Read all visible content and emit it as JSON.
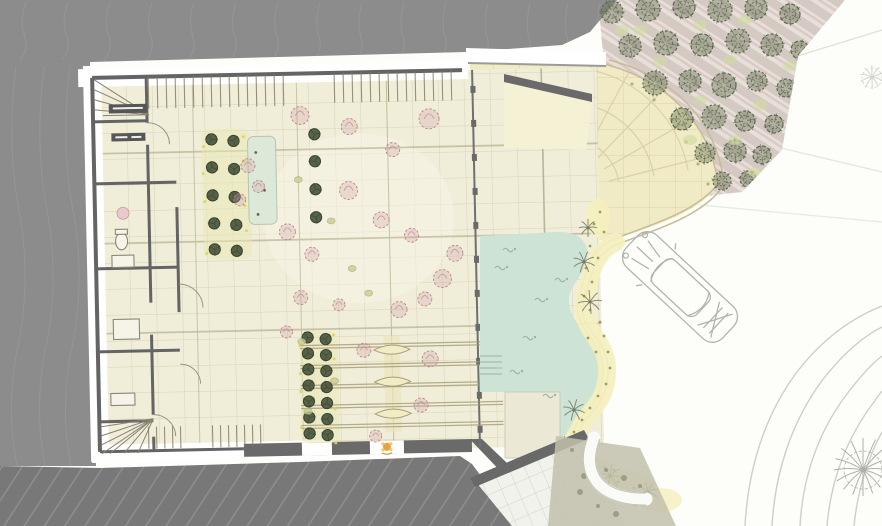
{
  "meta": {
    "drawing_type": "architectural-first-floor-site-plan",
    "canvas": {
      "width": 882,
      "height": 526
    },
    "visible_text": "none"
  },
  "palette": {
    "white": "#fdfdfa",
    "bg_gray": "#8c8c8c",
    "contour": "#9d9d9d",
    "hatch_base": "#787878",
    "hatch_line": "#8d8d8d",
    "wall": "#646464",
    "wall_dark": "#565656",
    "band": "#ffffff",
    "floor": "#f0edd9",
    "floor_grid": "#c1b897",
    "olive_line": "#a49a74",
    "plaza": "#f0ebc5",
    "plaza_line": "#d6cc9f",
    "tan_edge": "#c8bb95",
    "pool": "#cde3d5",
    "pool_line": "#9ab3a8",
    "deck": "#ece8d6",
    "tree_green": "#5c6850",
    "tree_fill": "#687554",
    "ground_tuft": "#cfdc9f",
    "stripe_a": "#d5c9c3",
    "stripe_b": "#e7e0d9",
    "stripe_pink": "#dcc9c7",
    "veg_yellow": "#f5efbe",
    "veg_dot": "#8f9148",
    "palm": "#737a66",
    "plant_dark": "#45523a",
    "plant_dot": "#dcd35a",
    "pink": "#bb8790",
    "pink_fill": "#cd96a0",
    "water_feature": "#dde9d8",
    "road_line": "#cfcfc8",
    "car_stroke": "#b4b4ae",
    "pave": "#f2f2ed",
    "pave_line": "#d3d3cb",
    "sketch_gray": "#a3a39c",
    "flower_orange": "#e8a23c"
  },
  "site": {
    "trees": [
      [
        612,
        12,
        11
      ],
      [
        648,
        9,
        12
      ],
      [
        684,
        7,
        11
      ],
      [
        720,
        10,
        12
      ],
      [
        756,
        8,
        11
      ],
      [
        790,
        14,
        10
      ],
      [
        630,
        46,
        11
      ],
      [
        666,
        43,
        12
      ],
      [
        702,
        45,
        11
      ],
      [
        738,
        41,
        12
      ],
      [
        772,
        45,
        11
      ],
      [
        800,
        50,
        9
      ],
      [
        655,
        83,
        12
      ],
      [
        690,
        81,
        11
      ],
      [
        724,
        85,
        12
      ],
      [
        757,
        81,
        10
      ],
      [
        786,
        88,
        9
      ],
      [
        682,
        119,
        11
      ],
      [
        714,
        117,
        12
      ],
      [
        745,
        121,
        10
      ],
      [
        774,
        124,
        9
      ],
      [
        705,
        153,
        10
      ],
      [
        735,
        151,
        11
      ],
      [
        762,
        155,
        9
      ],
      [
        722,
        181,
        9
      ],
      [
        748,
        179,
        8
      ]
    ],
    "tree_tufts": [
      [
        622,
        30
      ],
      [
        700,
        25
      ],
      [
        745,
        20
      ],
      [
        660,
        62
      ],
      [
        730,
        60
      ],
      [
        790,
        66
      ],
      [
        700,
        100
      ],
      [
        760,
        105
      ],
      [
        735,
        140
      ],
      [
        690,
        140
      ],
      [
        755,
        172
      ],
      [
        640,
        30
      ]
    ],
    "palms": [
      [
        588,
        228,
        9
      ],
      [
        584,
        262,
        11
      ],
      [
        590,
        302,
        12
      ],
      [
        574,
        410,
        11
      ],
      [
        566,
        446,
        10
      ],
      [
        610,
        476,
        12
      ],
      [
        648,
        492,
        10
      ]
    ],
    "veg_dots": [
      [
        600,
        212
      ],
      [
        594,
        224
      ],
      [
        604,
        232
      ],
      [
        590,
        246
      ],
      [
        598,
        258
      ],
      [
        586,
        268
      ],
      [
        592,
        282
      ],
      [
        584,
        296
      ],
      [
        590,
        310
      ],
      [
        600,
        322
      ],
      [
        604,
        336
      ],
      [
        608,
        352
      ],
      [
        610,
        368
      ],
      [
        606,
        384
      ],
      [
        598,
        396
      ],
      [
        590,
        408
      ],
      [
        582,
        420
      ],
      [
        574,
        432
      ],
      [
        566,
        444
      ],
      [
        560,
        456
      ],
      [
        572,
        462
      ],
      [
        588,
        470
      ],
      [
        602,
        476
      ],
      [
        618,
        482
      ],
      [
        634,
        488
      ],
      [
        650,
        494
      ],
      [
        614,
        470
      ],
      [
        578,
        448
      ],
      [
        596,
        352
      ],
      [
        588,
        338
      ]
    ],
    "arc_dots": [
      [
        632,
        84
      ],
      [
        654,
        100
      ],
      [
        672,
        120
      ],
      [
        686,
        142
      ],
      [
        698,
        164
      ],
      [
        708,
        184
      ]
    ],
    "plants_upper": [
      [
        214,
        138
      ],
      [
        236,
        140
      ],
      [
        214,
        166
      ],
      [
        236,
        168
      ],
      [
        214,
        194
      ],
      [
        236,
        196
      ],
      [
        215,
        222
      ],
      [
        237,
        224
      ],
      [
        215,
        248
      ],
      [
        237,
        250
      ],
      [
        317,
        135
      ],
      [
        317,
        162
      ],
      [
        317,
        190
      ],
      [
        317,
        218
      ]
    ],
    "plants_lower": [
      [
        306,
        338
      ],
      [
        324,
        340
      ],
      [
        306,
        354
      ],
      [
        324,
        356
      ],
      [
        306,
        370
      ],
      [
        324,
        372
      ],
      [
        306,
        386
      ],
      [
        324,
        388
      ],
      [
        306,
        402
      ],
      [
        324,
        404
      ],
      [
        306,
        418
      ],
      [
        324,
        420
      ],
      [
        306,
        434
      ],
      [
        324,
        436
      ]
    ],
    "yellow_dots": [
      [
        206,
        145
      ],
      [
        246,
        160
      ],
      [
        206,
        200
      ],
      [
        247,
        230
      ],
      [
        207,
        252
      ],
      [
        246,
        136
      ],
      [
        205,
        172
      ],
      [
        246,
        205
      ],
      [
        298,
        346
      ],
      [
        332,
        360
      ],
      [
        298,
        392
      ],
      [
        332,
        410
      ],
      [
        298,
        428
      ],
      [
        332,
        336
      ],
      [
        298,
        374
      ],
      [
        332,
        444
      ]
    ],
    "pink_sketches": [
      [
        303,
        116,
        9
      ],
      [
        352,
        128,
        8
      ],
      [
        432,
        122,
        10
      ],
      [
        395,
        152,
        7
      ],
      [
        350,
        192,
        9
      ],
      [
        382,
        222,
        8
      ],
      [
        412,
        238,
        7
      ],
      [
        455,
        257,
        8
      ],
      [
        442,
        282,
        9
      ],
      [
        424,
        302,
        7
      ],
      [
        398,
        312,
        8
      ],
      [
        300,
        298,
        7
      ],
      [
        338,
        306,
        6
      ],
      [
        312,
        255,
        7
      ],
      [
        288,
        232,
        8
      ],
      [
        250,
        165,
        7
      ],
      [
        260,
        186,
        6
      ],
      [
        241,
        199,
        6
      ],
      [
        285,
        332,
        6
      ],
      [
        362,
        352,
        7
      ],
      [
        428,
        362,
        8
      ],
      [
        418,
        408,
        7
      ],
      [
        372,
        438,
        6
      ]
    ],
    "olive_tufts": [
      [
        300,
        180
      ],
      [
        332,
        222
      ],
      [
        300,
        342
      ],
      [
        332,
        382
      ],
      [
        305,
        412
      ],
      [
        352,
        270
      ],
      [
        368,
        295
      ]
    ],
    "swimmers": [
      [
        508,
        250
      ],
      [
        500,
        268
      ],
      [
        540,
        300
      ],
      [
        528,
        338
      ],
      [
        515,
        372
      ],
      [
        548,
        396
      ],
      [
        560,
        280
      ]
    ],
    "contours_top": [
      26,
      68,
      110,
      152,
      194,
      236,
      278,
      320,
      362,
      404,
      446,
      488,
      530,
      568,
      600
    ],
    "contours_left": [
      16,
      44,
      70
    ],
    "sketch_trees": [
      [
        863,
        470,
        38,
        16,
        0.85
      ],
      [
        872,
        78,
        20,
        10,
        0.45
      ]
    ],
    "veg_speckles": [
      [
        572,
        450
      ],
      [
        590,
        462
      ],
      [
        606,
        470
      ],
      [
        624,
        478
      ],
      [
        640,
        486
      ],
      [
        584,
        476
      ],
      [
        600,
        488
      ],
      [
        618,
        496
      ],
      [
        636,
        504
      ],
      [
        580,
        492
      ],
      [
        598,
        506
      ],
      [
        616,
        514
      ]
    ]
  }
}
